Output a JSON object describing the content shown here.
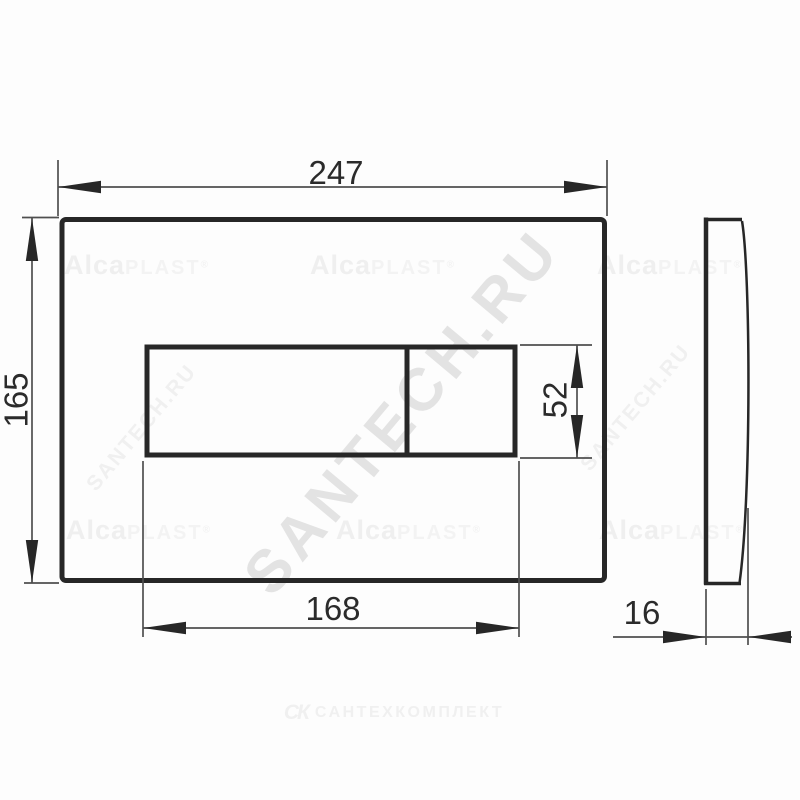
{
  "drawing_type": "technical-dimension-drawing",
  "dimensions": {
    "plate_width": "247",
    "plate_height": "165",
    "buttons_width": "168",
    "buttons_height": "52",
    "plate_depth": "16"
  },
  "watermarks": {
    "brand_main": "Alca",
    "brand_sub": "PLAST",
    "brand_reg": "®",
    "site": "SANTECH.RU",
    "footer_logo": "СК",
    "footer_text": "САНТЕХКОМПЛЕКТ"
  },
  "colors": {
    "line_heavy": "#272727",
    "line_thin": "#4f4f4f",
    "dim_text": "#2b2b2b",
    "watermark_brand": "#f1f1f1",
    "watermark_site_big": "#e3e3e3",
    "watermark_site_small": "#f0f0f0",
    "watermark_footer": "#f0f0f0",
    "background": "#fdfdfd"
  }
}
